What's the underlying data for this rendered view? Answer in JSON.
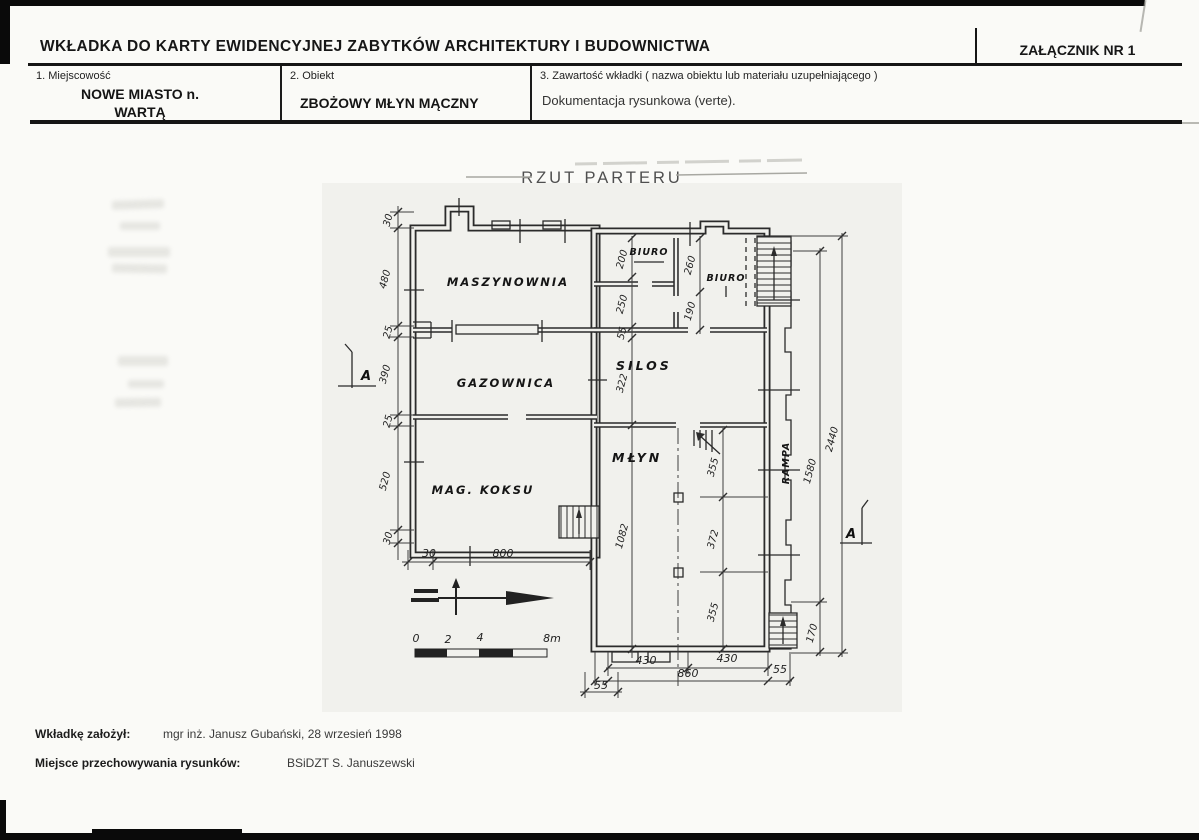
{
  "header": {
    "title": "WKŁADKA DO KARTY EWIDENCYJNEJ ZABYTKÓW ARCHITEKTURY I BUDOWNICTWA",
    "attachment": "ZAŁĄCZNIK NR 1",
    "field1": {
      "label": "1. Miejscowość",
      "value_line1": "NOWE MIASTO n.",
      "value_line2": "WARTĄ"
    },
    "field2": {
      "label": "2. Obiekt",
      "value": "ZBOŻOWY MŁYN MĄCZNY"
    },
    "field3": {
      "label": "3. Zawartość wkładki ( nazwa obiektu lub materiału uzupełniającego )",
      "value": "Dokumentacja rysunkowa (verte)."
    }
  },
  "drawing": {
    "title": "RZUT PARTERU",
    "rooms": {
      "maszynownia": "MASZYNOWNIA",
      "gazownica": "GAZOWNICA",
      "mag_koksu": "MAG. KOKSU",
      "biuro_1": "BIURO",
      "biuro_2": "BIURO",
      "silos": "SILOS",
      "mlyn": "MŁYN",
      "rampa": "RAMPA"
    },
    "section_marker": "A",
    "dims_left": [
      "30",
      "480",
      "25",
      "390",
      "25",
      "520",
      "30"
    ],
    "dims_bottom_left": [
      "30",
      "800"
    ],
    "dims_mid_chain": [
      "200",
      "250",
      "55",
      "322",
      "1082"
    ],
    "dims_biuro_chain": [
      "260",
      "190"
    ],
    "dims_mlyn_chain": [
      "355",
      "372",
      "355"
    ],
    "dims_right_chain": [
      "1580",
      "2440",
      "170"
    ],
    "dims_bottom": [
      "430",
      "430",
      "860",
      "55",
      "55"
    ],
    "scale_bar": {
      "t0": "0",
      "t1": "2",
      "t2": "4",
      "t3": "8m"
    }
  },
  "footer": {
    "created_label": "Wkładkę założył:",
    "created_value": "mgr inż. Janusz Gubański, 28 wrzesień 1998",
    "storage_label": "Miejsce przechowywania rysunków:",
    "storage_value": "BSiDZT S. Januszewski"
  }
}
